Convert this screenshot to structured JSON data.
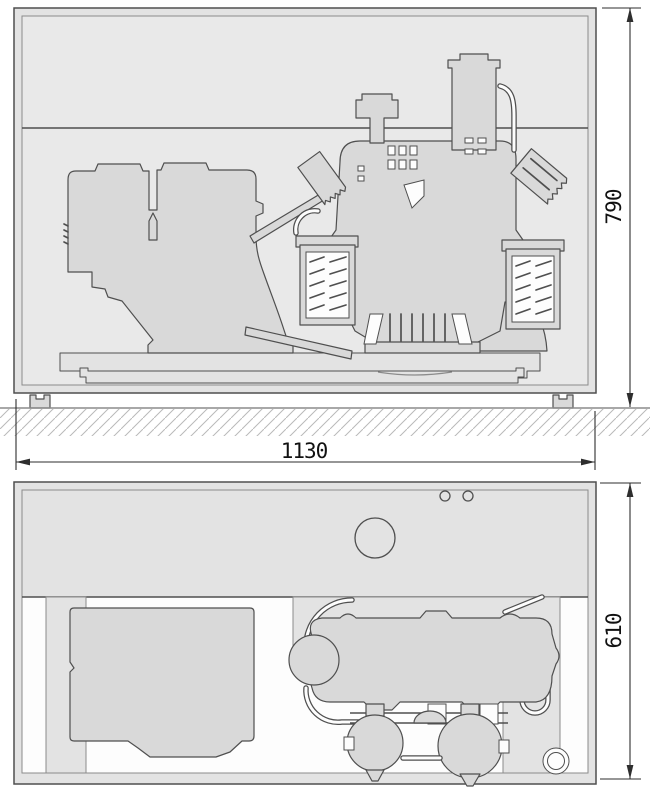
{
  "dimensions": {
    "height_label": "790",
    "width_label": "1130",
    "depth_label": "610"
  },
  "colors": {
    "line": "#4f4f4f",
    "thin_line": "#8b8b8b",
    "dim_line": "#2e2e2e",
    "dim_text": "#111111",
    "enclosure_fill": "#e3e3e3",
    "interior_fill": "#e9e9e9",
    "machine_fill": "#d9d9d9",
    "hatch": "#b9b9b9",
    "white": "#fdfdfd"
  }
}
